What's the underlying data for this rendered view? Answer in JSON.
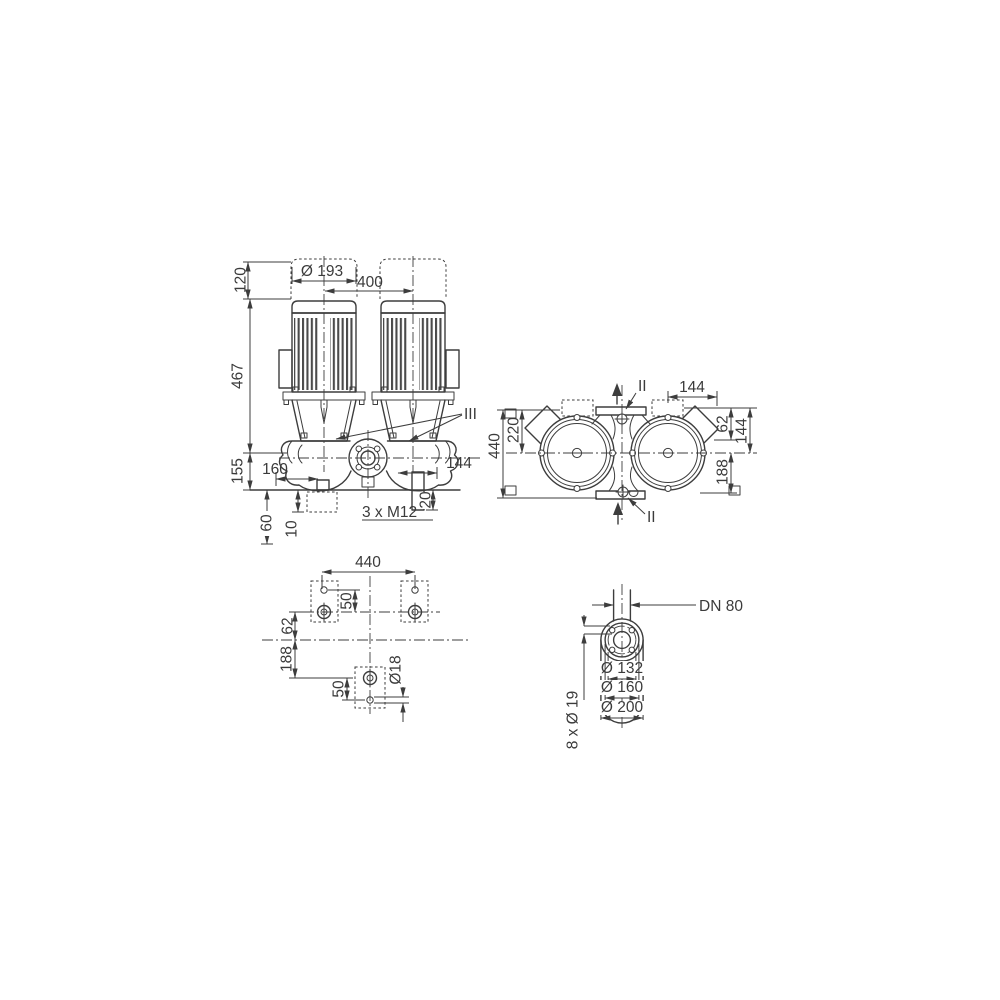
{
  "meta": {
    "background": "#ffffff",
    "line_color": "#3d3d3d",
    "text_color": "#3b3b3b"
  },
  "front_view": {
    "dims": {
      "top_clearance": "120",
      "height": "467",
      "base_height": "155",
      "motor_diameter": "Ø 193",
      "port_spacing": "400",
      "left_port": "160",
      "right_port": "144",
      "foot_height": "20",
      "tapped_holes": "3 x M12",
      "depth_a": "60",
      "depth_b": "10"
    },
    "section_label": "III"
  },
  "top_view": {
    "dims": {
      "length": "440",
      "half_length": "220",
      "motor_width": "144",
      "flange_to_hole": "62",
      "flange_to_axis": "144",
      "axis_to_hole": "188"
    },
    "section_label_top": "II",
    "section_label_bottom": "II"
  },
  "foundation_view": {
    "dims": {
      "hole_spacing": "440",
      "slot_upper": "50",
      "axis_offset_upper": "62",
      "axis_offset_lower": "188",
      "slot_lower": "50",
      "hole_diameter": "Ø18"
    }
  },
  "flange_view": {
    "nominal_diameter": "DN 80",
    "dims": {
      "bolt_circle": "Ø 132",
      "raised_face": "Ø 160",
      "outer_diameter": "Ø 200",
      "bolt_holes": "8 x Ø 19"
    }
  }
}
